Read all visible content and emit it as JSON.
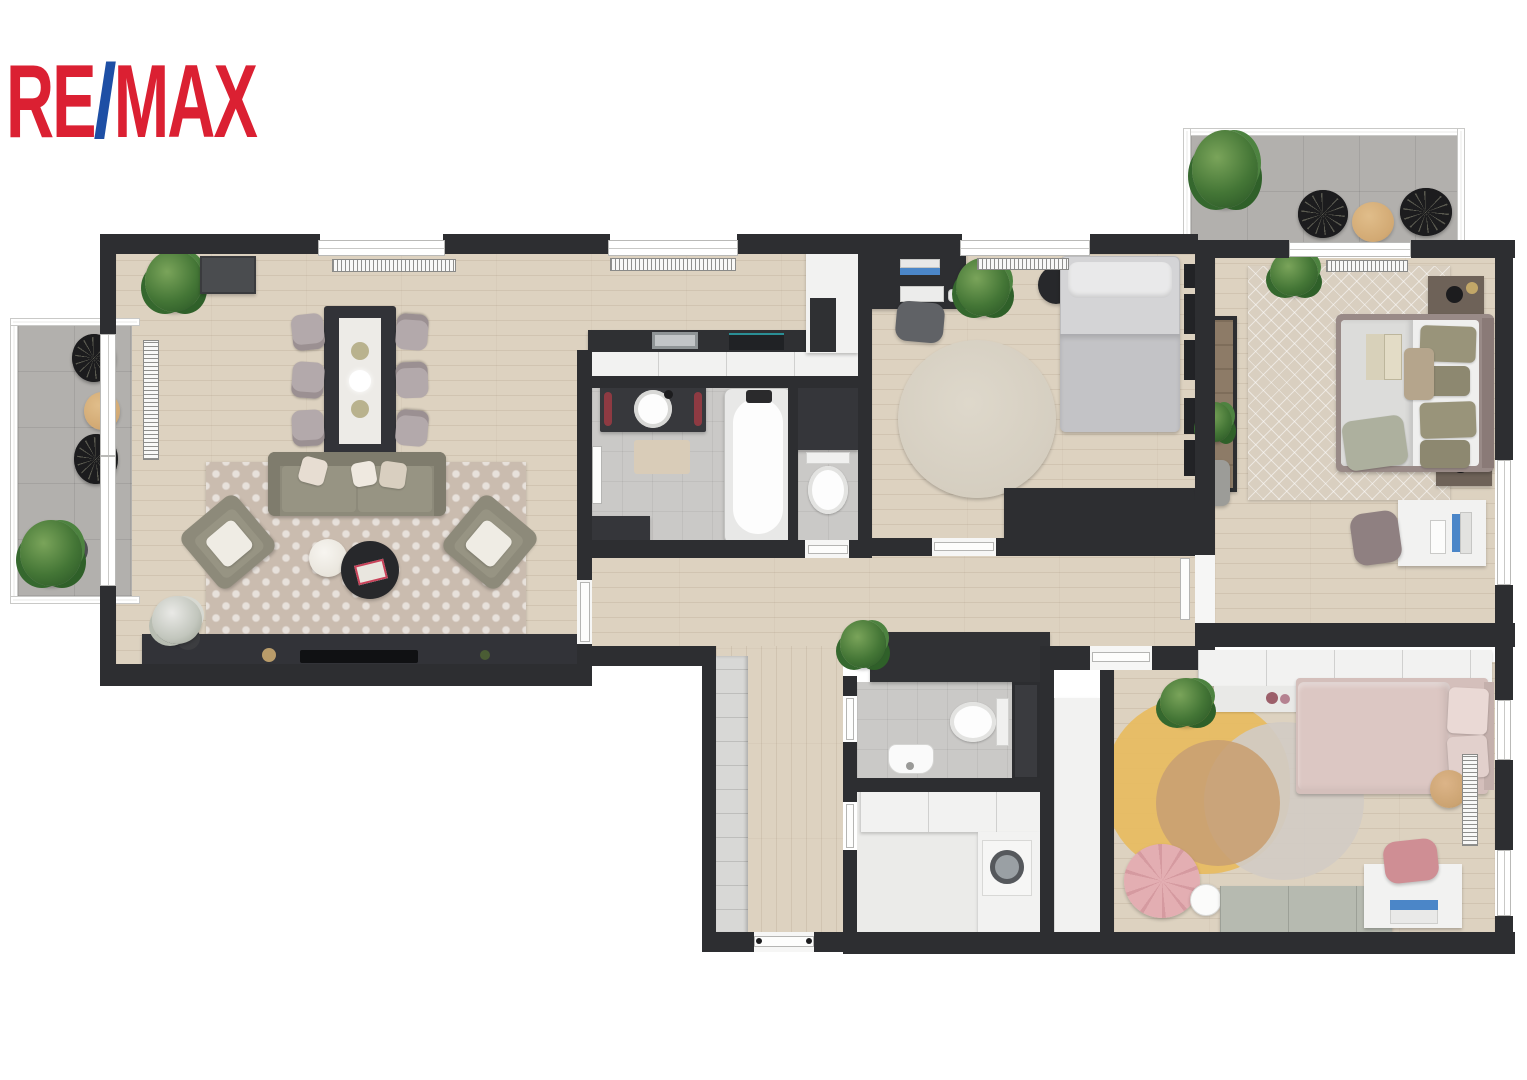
{
  "logo": {
    "re": "RE",
    "slash": "/",
    "max": "MAX"
  },
  "brand": {
    "name": "RE/MAX",
    "red": "#db2032",
    "blue": "#1e4fa5"
  },
  "palette": {
    "wall": "#2d2e31",
    "wood_floor": "#ddd2c0",
    "balcony_tile": "#b2b0ad",
    "bath_floor": "#cac9c7",
    "white_furniture": "#f2f2f1",
    "sofa_olive": "#8d8a7a",
    "kids_pink": "#dcc7c3",
    "rug_yellow": "#e7bc62",
    "rug_tan": "#c9a072",
    "plant_green": "#447636",
    "accent_wood": "#d2a973",
    "screen_blue": "#4b86c8",
    "towel_red": "#8e3a42"
  },
  "plan": {
    "type": "3d-floor-plan-top-down-render",
    "rooms": [
      {
        "name": "living-dining-room",
        "furniture": [
          "dining-table",
          "dining-chair x6",
          "sofa",
          "armchair x2",
          "coffee-table-white",
          "coffee-table-dark",
          "trellis-rug",
          "tv-console",
          "tv",
          "bar-cabinet",
          "plant",
          "flower-vase",
          "radiator x2"
        ]
      },
      {
        "name": "kitchen",
        "furniture": [
          "l-shaped-counter",
          "sink",
          "cooktop",
          "tall-cabinet-column",
          "radiator"
        ]
      },
      {
        "name": "bathroom",
        "furniture": [
          "vanity-with-round-basin",
          "towel-rail x2",
          "bathtub",
          "bath-mat",
          "low-cabinet"
        ]
      },
      {
        "name": "wc-1",
        "furniture": [
          "toilet",
          "storage-shelf"
        ]
      },
      {
        "name": "study-bedroom",
        "furniture": [
          "desk",
          "monitor",
          "keyboard",
          "mouse",
          "office-chair",
          "single-bed",
          "round-rug",
          "sideboard",
          "round-side-table",
          "plant",
          "wall-frames x5",
          "radiator"
        ]
      },
      {
        "name": "master-bedroom",
        "furniture": [
          "double-bed",
          "nightstand x2",
          "table-lamp x2",
          "wardrobe",
          "diamond-rug",
          "desk",
          "monitor",
          "desk-chair",
          "side-chair",
          "plant x2",
          "book",
          "radiator"
        ]
      },
      {
        "name": "hallway",
        "furniture": [
          "closet",
          "built-in-cabinet",
          "plant"
        ]
      },
      {
        "name": "wc-2",
        "furniture": [
          "toilet",
          "hand-basin",
          "glass-panel"
        ]
      },
      {
        "name": "utility-room",
        "furniture": [
          "washing-machine",
          "counter-cabinets",
          "tall-cabinet"
        ]
      },
      {
        "name": "kids-room",
        "furniture": [
          "single-bed-pink",
          "wardrobe",
          "wall-shelf",
          "organic-rug",
          "pouf",
          "floor-lamp",
          "storage-bench",
          "desk",
          "laptop",
          "desk-chair",
          "stool",
          "plant",
          "radiator"
        ]
      },
      {
        "name": "balcony-left",
        "furniture": [
          "lounge-chair x2",
          "round-table",
          "plant"
        ]
      },
      {
        "name": "balcony-top-right",
        "furniture": [
          "lounge-chair x2",
          "round-table",
          "plant"
        ]
      }
    ]
  }
}
